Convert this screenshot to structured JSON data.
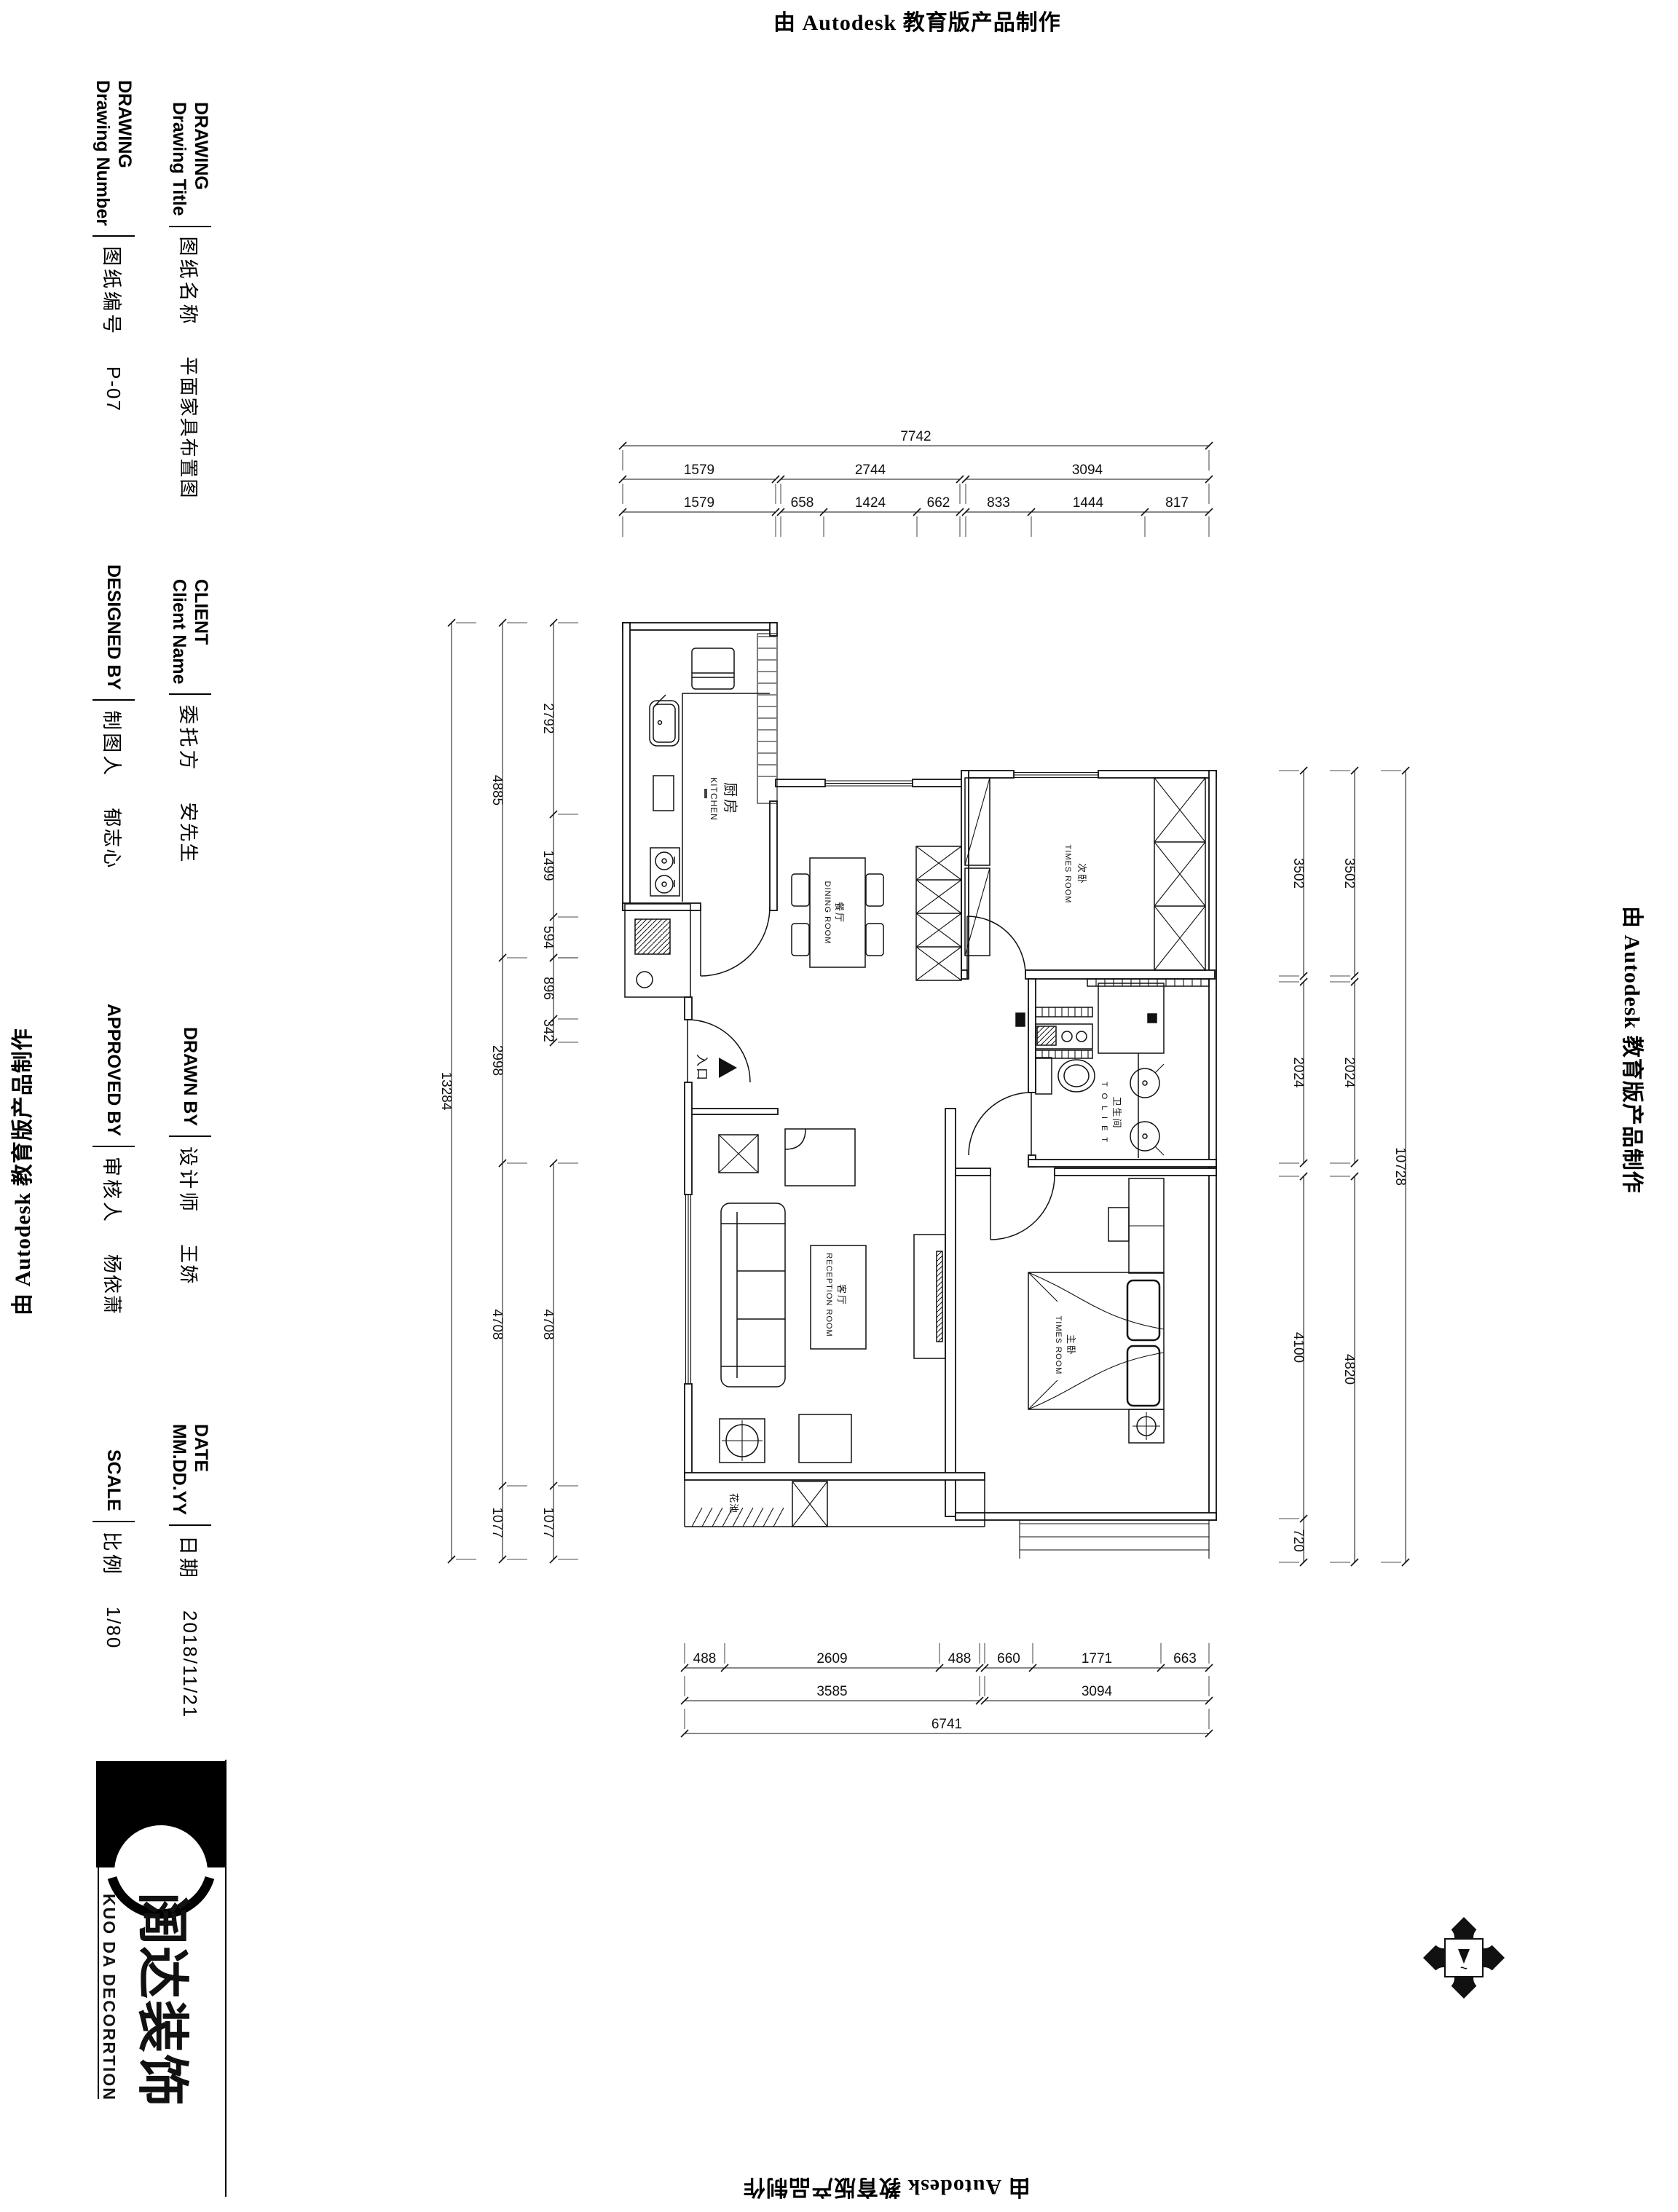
{
  "credit": "由 Autodesk 教育版产品制作",
  "title_block": {
    "right_col": [
      {
        "heading": "DRAWING",
        "sub": "Drawing Title",
        "label": "图纸名称",
        "value": "平面家具布置图"
      },
      {
        "heading": "CLIENT",
        "sub": "Client Name",
        "label": "委托方",
        "value": "安先生"
      },
      {
        "heading": "DRAWN BY",
        "sub": "",
        "label": "设计师",
        "value": "王娇"
      },
      {
        "heading": "DATE",
        "sub": "MM.DD.YY",
        "label": "日期",
        "value": "2018/11/21"
      }
    ],
    "left_col": [
      {
        "heading": "DRAWING",
        "sub": "Drawing Number",
        "label": "图纸编号",
        "value": "P-07"
      },
      {
        "heading": "DESIGNED BY",
        "sub": "",
        "label": "制图人",
        "value": "郁志心"
      },
      {
        "heading": "APPROVED BY",
        "sub": "",
        "label": "审核人",
        "value": "杨依萧"
      },
      {
        "heading": "SCALE",
        "sub": "",
        "label": "比例",
        "value": "1/80"
      }
    ]
  },
  "logo": {
    "cn": "阔达装饰",
    "en": "KUO DA DECORRTION"
  },
  "plan": {
    "rooms": {
      "kitchen": {
        "cn": "厨房",
        "en": "KITCHEN"
      },
      "dining": {
        "cn": "餐厅",
        "en": "DINING ROOM"
      },
      "bedroom2": {
        "cn": "次卧",
        "en": "TIMES ROOM"
      },
      "toilet": {
        "cn": "卫生间",
        "en": "T O L I E T"
      },
      "living": {
        "cn": "客厅",
        "en": "RECEPTION ROOM"
      },
      "master": {
        "cn": "主卧",
        "en": "TIMES ROOM"
      }
    },
    "labels": {
      "entrance": "入口",
      "flower": "花池"
    },
    "dims": {
      "top_total": "7742",
      "top_mid": [
        "1579",
        "2744",
        "3094"
      ],
      "top_inner": [
        "1579",
        "658",
        "1424",
        "662",
        "833",
        "1444",
        "817"
      ],
      "left_total": "13284",
      "left_mid": [
        "4885",
        "2998",
        "4708",
        "1077"
      ],
      "left_inner": [
        "2792",
        "1499",
        "594",
        "896",
        "342",
        "4708",
        "1077"
      ],
      "right_total": "10728",
      "right_mid": [
        "3502",
        "2024",
        "4820"
      ],
      "right_inner": [
        "3502",
        "2024",
        "4100",
        "720"
      ],
      "bottom_total": "6741",
      "bottom_mid": [
        "3585",
        "3094"
      ],
      "bottom_inner": [
        "488",
        "2609",
        "488",
        "660",
        "1771",
        "663"
      ]
    }
  }
}
